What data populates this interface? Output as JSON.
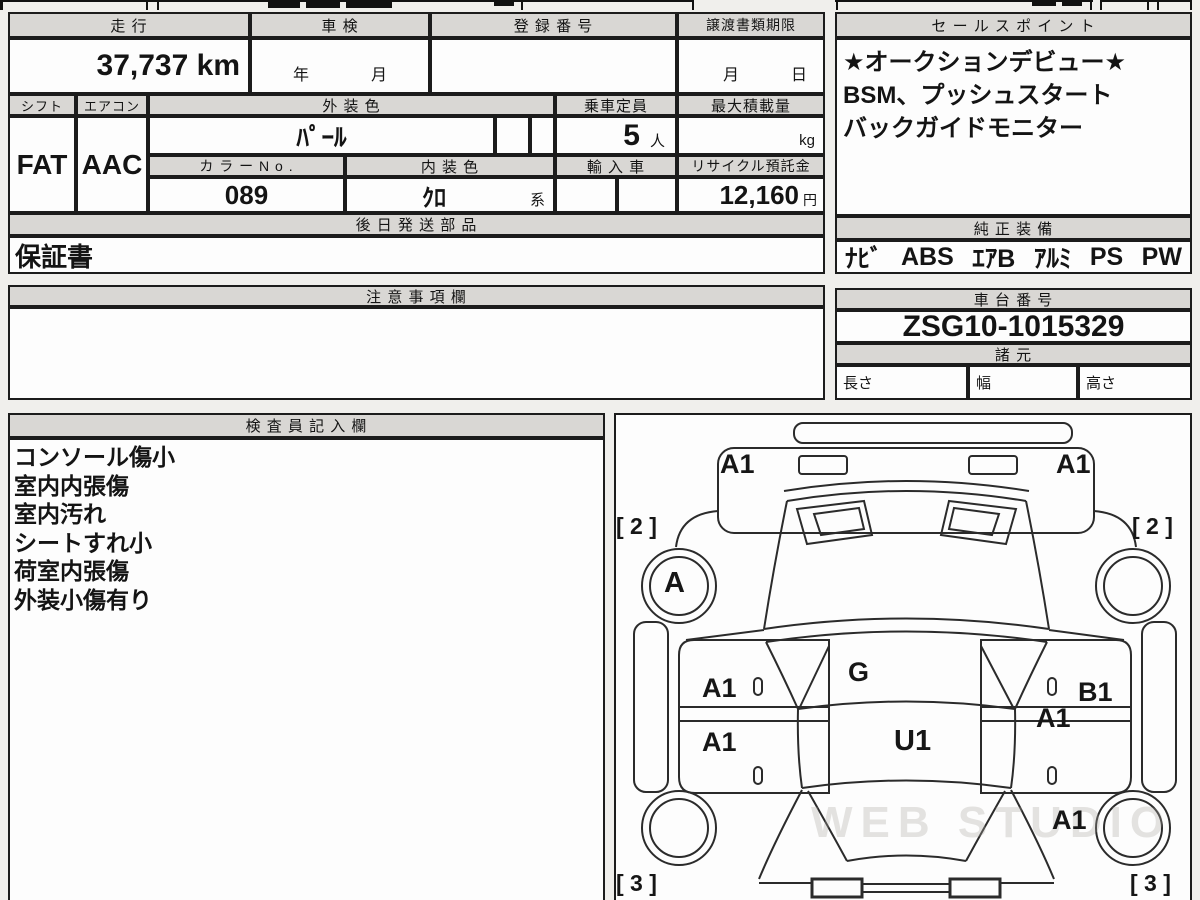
{
  "top_table": {
    "mileage": {
      "header": "走 行",
      "value": "37,737 km"
    },
    "inspection": {
      "header": "車 検",
      "year_label": "年",
      "month_label": "月"
    },
    "registration": {
      "header": "登 録 番 号",
      "value": ""
    },
    "transfer_deadline": {
      "header": "譲渡書類期限",
      "month_label": "月",
      "day_label": "日"
    },
    "shift": {
      "header": "シフト",
      "value": "FAT"
    },
    "aircon": {
      "header": "エアコン",
      "value": "AAC"
    },
    "exterior_color": {
      "header": "外 装 色",
      "value": "ﾊﾟｰﾙ"
    },
    "capacity": {
      "header": "乗車定員",
      "value": "5",
      "unit": "人"
    },
    "max_load": {
      "header": "最大積載量",
      "unit": "kg"
    },
    "color_no": {
      "header": "カ ラ ー N o .",
      "value": "089"
    },
    "interior_color": {
      "header": "内 装 色",
      "value": "ｸﾛ",
      "suffix": "系"
    },
    "import_car": {
      "header": "輸 入 車"
    },
    "recycle_deposit": {
      "header": "リサイクル預託金",
      "value": "12,160",
      "unit": "円"
    },
    "later_parts": {
      "header": "後 日 発 送 部 品",
      "value": "保証書"
    }
  },
  "sales_points": {
    "header": "セ ー ル ス ポ イ ン ト",
    "lines": [
      "★オークションデビュー★",
      "BSM、プッシュスタート",
      "バックガイドモニター"
    ]
  },
  "equipment": {
    "header": "純 正 装 備",
    "items": [
      "ﾅﾋﾞ",
      "ABS",
      "ｴｱB",
      "ｱﾙﾐ",
      "PS",
      "PW"
    ]
  },
  "notes_section": {
    "header": "注 意 事 項 欄",
    "value": ""
  },
  "chassis": {
    "header": "車 台 番 号",
    "value": "ZSG10-1015329"
  },
  "specs": {
    "header": "諸 元",
    "length_label": "長さ",
    "width_label": "幅",
    "height_label": "高さ"
  },
  "inspector_notes": {
    "header": "検 査 員 記 入 欄",
    "lines": [
      "コンソール傷小",
      "室内内張傷",
      "室内汚れ",
      "シートすれ小",
      "荷室内張傷",
      "外装小傷有り"
    ]
  },
  "diagram": {
    "front_bumper_left": "A1",
    "front_bumper_right": "A1",
    "front_tire_left": "[ 2 ]",
    "front_tire_right": "[ 2 ]",
    "front_wheel_left": "A",
    "cowl": "G",
    "front_door_left": "A1",
    "rear_door_left": "A1",
    "roof": "U1",
    "front_door_right": "B1",
    "front_door_right_2": "A1",
    "rear_fender_right": "A1",
    "rear_tire_left": "[ 3 ]",
    "rear_tire_right": "[ 3 ]",
    "watermark": "WEB STUDIO"
  }
}
